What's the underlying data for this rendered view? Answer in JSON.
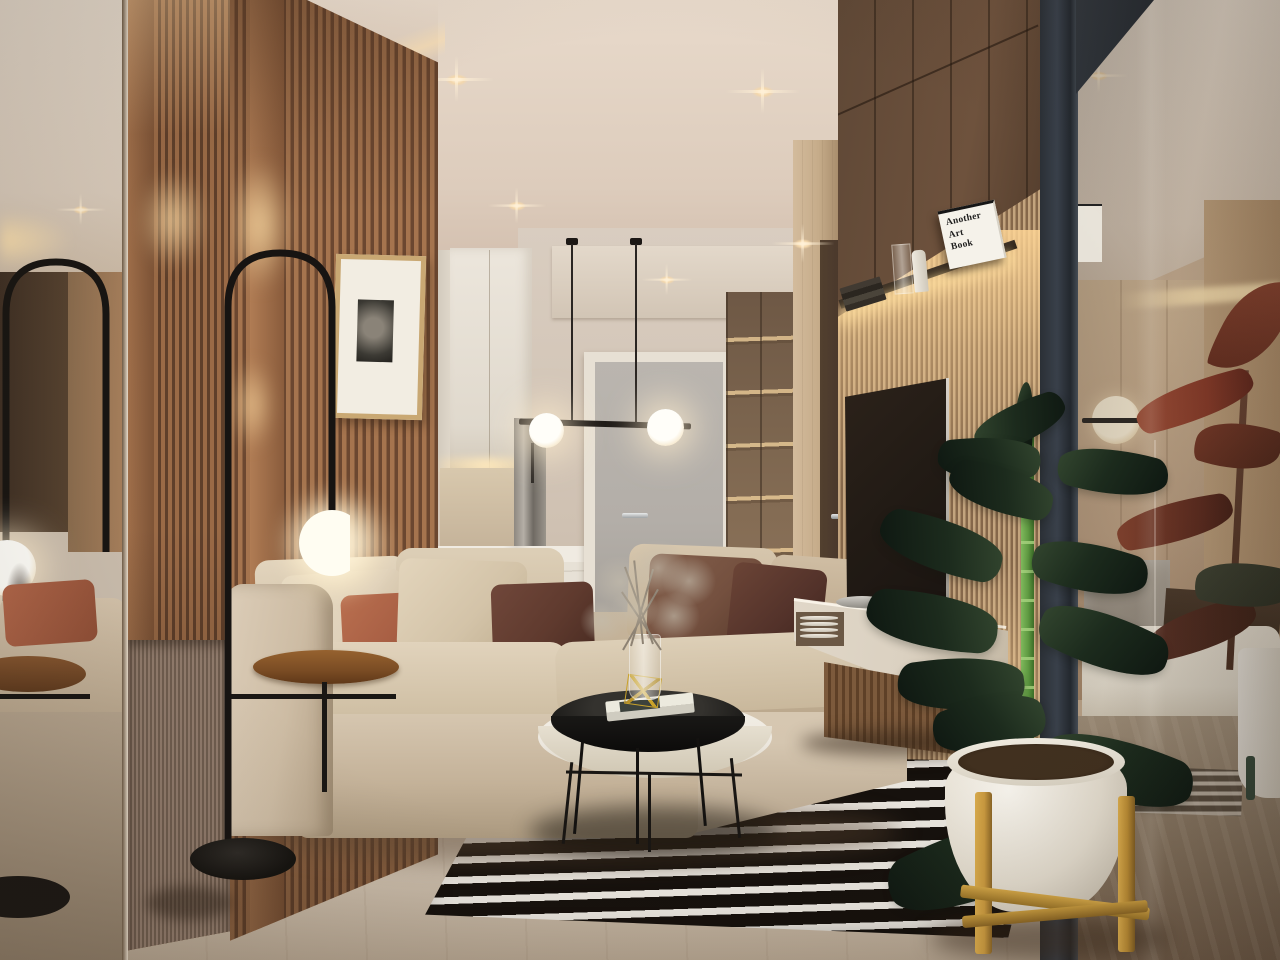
{
  "scene": {
    "type": "interior-3d-render",
    "room": "modern apartment living room with kitchen corridor, TV wall and glass-partitioned bedroom",
    "style": "warm minimalist, wood slat walls, evening artificial lighting"
  },
  "book": {
    "title": "Another Art Book",
    "lines": [
      "Another",
      "Art",
      "Book"
    ]
  },
  "inventory": {
    "ceiling_spotlights": 5,
    "pendant_globes": 2,
    "arc_floor_lamps": 1,
    "sofa_pillows": 6,
    "rug": "black and white striped",
    "plants": [
      "green rubber plant in white pot with wood stand",
      "red rubber plant behind glass"
    ],
    "tables": [
      "black round tray coffee table",
      "white round coffee table",
      "round wooden side table"
    ],
    "wall_art": "framed black and white photo",
    "shelf_objects": [
      "stacked books",
      "glass vase",
      "white bottle",
      "art book"
    ]
  },
  "palette": {
    "wall": "#d6c8b9",
    "ceilA": "#e8dacb",
    "ceilB": "#c9b3a2",
    "woodA": "#a5744e",
    "woodB": "#6b4730",
    "slatFineA": "#c3a47e",
    "slatFineB": "#85674a",
    "flute": "#8a7466",
    "floorA": "#d7cbbb",
    "floorB": "#b2a28e",
    "sofa": "#d5c6b0",
    "sofaDark": "#b3a189",
    "pillowCream": "#e0d2bb",
    "pillowRust": "#a85f44",
    "pillowMaroon": "#5f3a2e",
    "pillowBrown": "#74503f",
    "rugBlack": "#16110d",
    "rugWhite": "#e9e5de",
    "metal": "#1d1a17",
    "tv": "#221b15",
    "console": "#dbd1c1",
    "doorGray": "#b3aea8",
    "doorDark": "#46342a",
    "glassBar": "#39404a",
    "marble": "#ece7de",
    "stemGreen": "#5f9a42",
    "potWhite": "#f1ede4",
    "standWood": "#c9993f",
    "redLeafA": "#8a3a28",
    "redLeafB": "#5e2a1e",
    "roomWall": "#c7ae92",
    "marbleGray": "#9a9184",
    "daybed": "#e9e2d3"
  }
}
